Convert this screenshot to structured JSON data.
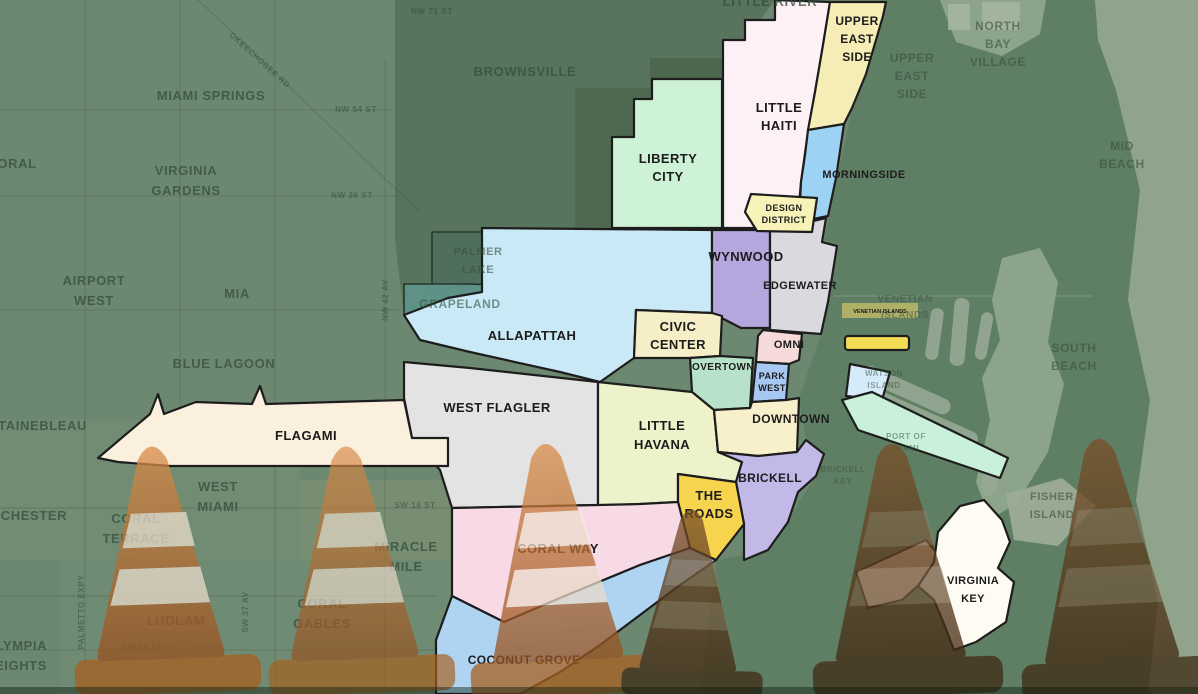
{
  "map_title": "Miami neighborhoods map",
  "districts": [
    {
      "id": "liberty-city",
      "lines": [
        "LIBERTY",
        "CITY"
      ],
      "color": "#cdf2d6"
    },
    {
      "id": "little-haiti",
      "lines": [
        "LITTLE",
        "HAITI"
      ],
      "color": "#fdf1f6"
    },
    {
      "id": "upper-east-side",
      "lines": [
        "UPPER",
        "EAST",
        "SIDE"
      ],
      "color": "#f6edb6"
    },
    {
      "id": "morningside",
      "lines": [
        "MORNINGSIDE"
      ],
      "color": "#9ed2f4"
    },
    {
      "id": "design-district",
      "lines": [
        "DESIGN",
        "DISTRICT"
      ],
      "color": "#f6f2b8"
    },
    {
      "id": "wynwood",
      "lines": [
        "WYNWOOD"
      ],
      "color": "#b3a7dd"
    },
    {
      "id": "edgewater",
      "lines": [
        "EDGEWATER"
      ],
      "color": "#d9d9de"
    },
    {
      "id": "civic-center",
      "lines": [
        "CIVIC",
        "CENTER"
      ],
      "color": "#f6eec6"
    },
    {
      "id": "overtown",
      "lines": [
        "OVERTOWN"
      ],
      "color": "#b7e2c9"
    },
    {
      "id": "omni",
      "lines": [
        "OMNI"
      ],
      "color": "#f6dada"
    },
    {
      "id": "park-west",
      "lines": [
        "PARK",
        "WEST"
      ],
      "color": "#a6c8f2"
    },
    {
      "id": "downtown",
      "lines": [
        "DOWNTOWN"
      ],
      "color": "#f8f0ca"
    },
    {
      "id": "allapattah",
      "lines": [
        "ALLAPATTAH"
      ],
      "color": "#c9e9f6"
    },
    {
      "id": "west-flagler",
      "lines": [
        "WEST FLAGLER"
      ],
      "color": "#e3e3e3"
    },
    {
      "id": "flagami",
      "lines": [
        "FLAGAMI"
      ],
      "color": "#fbf0de"
    },
    {
      "id": "little-havana",
      "lines": [
        "LITTLE",
        "HAVANA"
      ],
      "color": "#eef2cb"
    },
    {
      "id": "brickell",
      "lines": [
        "BRICKELL"
      ],
      "color": "#c3b9e8"
    },
    {
      "id": "the-roads",
      "lines": [
        "THE",
        "ROADS"
      ],
      "color": "#f6d44e"
    },
    {
      "id": "coral-way",
      "lines": [
        "CORAL WAY"
      ],
      "color": "#f8d9e6"
    },
    {
      "id": "coconut-grove",
      "lines": [
        "COCONUT GROVE"
      ],
      "color": "#aed4f2"
    },
    {
      "id": "virginia-key",
      "lines": [
        "VIRGINIA",
        "KEY"
      ],
      "color": "#fdfbf2"
    },
    {
      "id": "watson-island",
      "lines": [],
      "color": "#d6ebfa"
    },
    {
      "id": "port-of-miami",
      "lines": [],
      "color": "#c9f0d8"
    },
    {
      "id": "venetian-islands",
      "lines": [
        "VENETIAN ISLANDS"
      ],
      "color": "#f2dd55"
    }
  ],
  "bg_labels": [
    {
      "id": "doral",
      "lines": [
        "DORAL"
      ]
    },
    {
      "id": "miami-springs",
      "lines": [
        "MIAMI SPRINGS"
      ]
    },
    {
      "id": "virginia-gardens",
      "lines": [
        "VIRGINIA",
        "GARDENS"
      ]
    },
    {
      "id": "brownsville",
      "lines": [
        "BROWNSVILLE"
      ]
    },
    {
      "id": "little-river",
      "lines": [
        "LITTLE RIVER"
      ]
    },
    {
      "id": "upper-east-side-bg",
      "lines": [
        "UPPER",
        "EAST",
        "SIDE"
      ]
    },
    {
      "id": "north-bay-village",
      "lines": [
        "NORTH",
        "BAY",
        "VILLAGE"
      ]
    },
    {
      "id": "mid-beach",
      "lines": [
        "MID",
        "BEACH"
      ]
    },
    {
      "id": "south-beach",
      "lines": [
        "SOUTH",
        "BEACH"
      ]
    },
    {
      "id": "venetian-islands-bg",
      "lines": [
        "VENETIAN",
        "ISLANDS"
      ]
    },
    {
      "id": "airport-west",
      "lines": [
        "AIRPORT",
        "WEST"
      ]
    },
    {
      "id": "mia",
      "lines": [
        "MIA"
      ]
    },
    {
      "id": "blue-lagoon",
      "lines": [
        "BLUE LAGOON"
      ]
    },
    {
      "id": "fontainebleau",
      "lines": [
        "FONTAINEBLEAU"
      ]
    },
    {
      "id": "westchester",
      "lines": [
        "WESTCHESTER"
      ]
    },
    {
      "id": "olympia-heights",
      "lines": [
        "OLYMPIA",
        "HEIGHTS"
      ]
    },
    {
      "id": "coral-terrace",
      "lines": [
        "CORAL",
        "TERRACE"
      ]
    },
    {
      "id": "west-miami",
      "lines": [
        "WEST",
        "MIAMI"
      ]
    },
    {
      "id": "ludlam",
      "lines": [
        "LUDLAM"
      ]
    },
    {
      "id": "coral-gables",
      "lines": [
        "CORAL",
        "GABLES"
      ]
    },
    {
      "id": "miracle-mile",
      "lines": [
        "MIRACLE",
        "MILE"
      ]
    },
    {
      "id": "palmer-lake",
      "lines": [
        "PALMER",
        "LAKE"
      ]
    },
    {
      "id": "grapeland",
      "lines": [
        "GRAPELAND"
      ]
    },
    {
      "id": "watson-island-bg",
      "lines": [
        "WATSON",
        "ISLAND"
      ]
    },
    {
      "id": "port-of-miami-bg",
      "lines": [
        "PORT OF",
        "MIAMI"
      ]
    },
    {
      "id": "brickell-key",
      "lines": [
        "BRICKELL",
        "KEY"
      ]
    },
    {
      "id": "fisher-island",
      "lines": [
        "FISHER",
        "ISLAND"
      ]
    }
  ],
  "streets": [
    {
      "text": "NW 54 ST"
    },
    {
      "text": "NW 36 ST"
    },
    {
      "text": "NW 71 ST"
    },
    {
      "text": "OKEECHOBEE RD"
    },
    {
      "text": "NW 42 AV"
    },
    {
      "text": "SW 16 ST"
    },
    {
      "text": "SW 37 AV"
    },
    {
      "text": "SW 40 ST"
    },
    {
      "text": "PALMETTO EXPY"
    }
  ],
  "overlay": {
    "cone_count": 6
  },
  "colors": {
    "base": "#6d8870",
    "bay": "#5f7f64",
    "beach": "#92a68e",
    "district_stroke": "#1d1d1d",
    "bg_label": "#36503c",
    "cone_light": "#b3602a",
    "cone_dark": "#53351b"
  }
}
